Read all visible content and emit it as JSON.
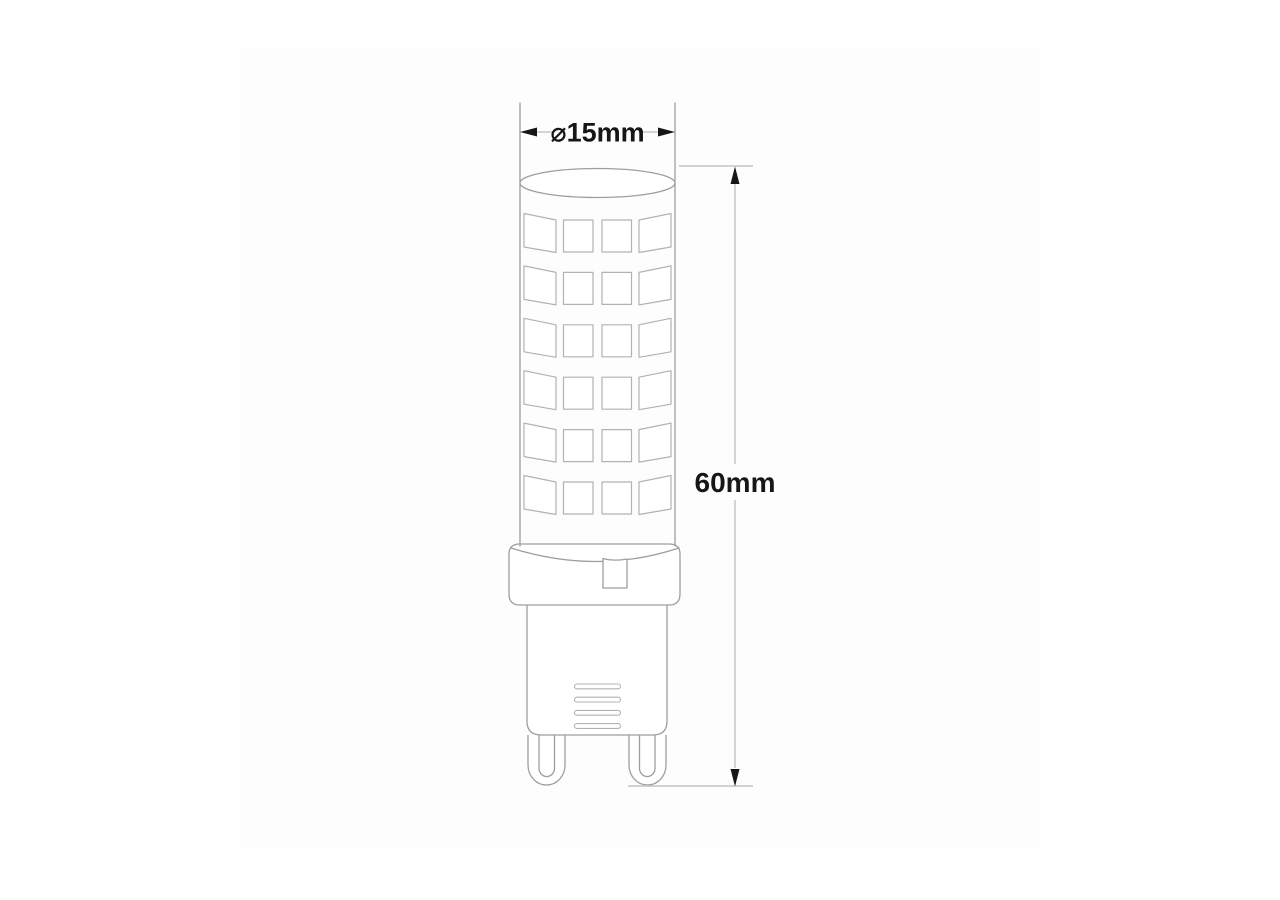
{
  "page": {
    "background": "#ffffff"
  },
  "diagram": {
    "type": "technical-dimension-drawing",
    "subject": "G9 LED capsule light bulb",
    "canvas_color": "#fdfdfd",
    "colors": {
      "outline": "#9e9e9e",
      "led_outline": "#b2b2b2",
      "dimension_line": "#c3c3c3",
      "dimension_ink": "#161616"
    },
    "led_grid": {
      "rows": 6,
      "columns": 4
    },
    "vent_slots": 4,
    "pins": 2,
    "dimensions": {
      "diameter": {
        "label": "⌀15mm",
        "value_mm": 15
      },
      "height": {
        "label": "60mm",
        "value_mm": 60
      }
    }
  }
}
